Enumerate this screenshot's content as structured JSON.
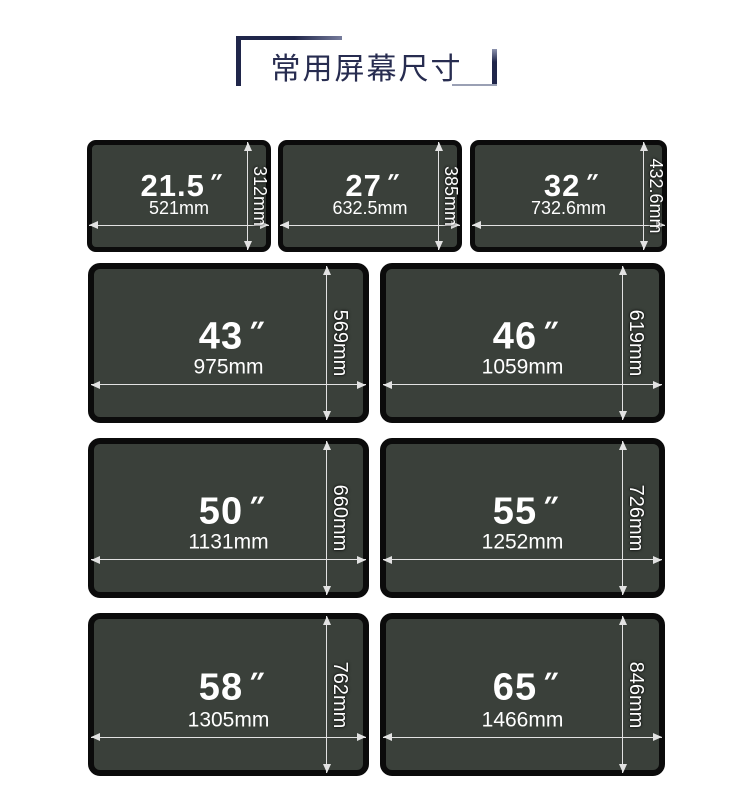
{
  "title": "常用屏幕尺寸",
  "colors": {
    "accent-navy": "#20264a",
    "accent-light": "#9aa0b4",
    "screen-fill": "#3a403a",
    "screen-border": "#0b0b0b",
    "dim-line": "#e2e2e2",
    "label-white": "#ffffff"
  },
  "screens": [
    {
      "size": "21.5",
      "unit": "″",
      "width": "521mm",
      "height": "312mm"
    },
    {
      "size": "27",
      "unit": "″",
      "width": "632.5mm",
      "height": "385mm"
    },
    {
      "size": "32",
      "unit": "″",
      "width": "732.6mm",
      "height": "432.6mm"
    },
    {
      "size": "43",
      "unit": "″",
      "width": "975mm",
      "height": "569mm"
    },
    {
      "size": "46",
      "unit": "″",
      "width": "1059mm",
      "height": "619mm"
    },
    {
      "size": "50",
      "unit": "″",
      "width": "1131mm",
      "height": "660mm"
    },
    {
      "size": "55",
      "unit": "″",
      "width": "1252mm",
      "height": "726mm"
    },
    {
      "size": "58",
      "unit": "″",
      "width": "1305mm",
      "height": "762mm"
    },
    {
      "size": "65",
      "unit": "″",
      "width": "1466mm",
      "height": "846mm"
    }
  ]
}
